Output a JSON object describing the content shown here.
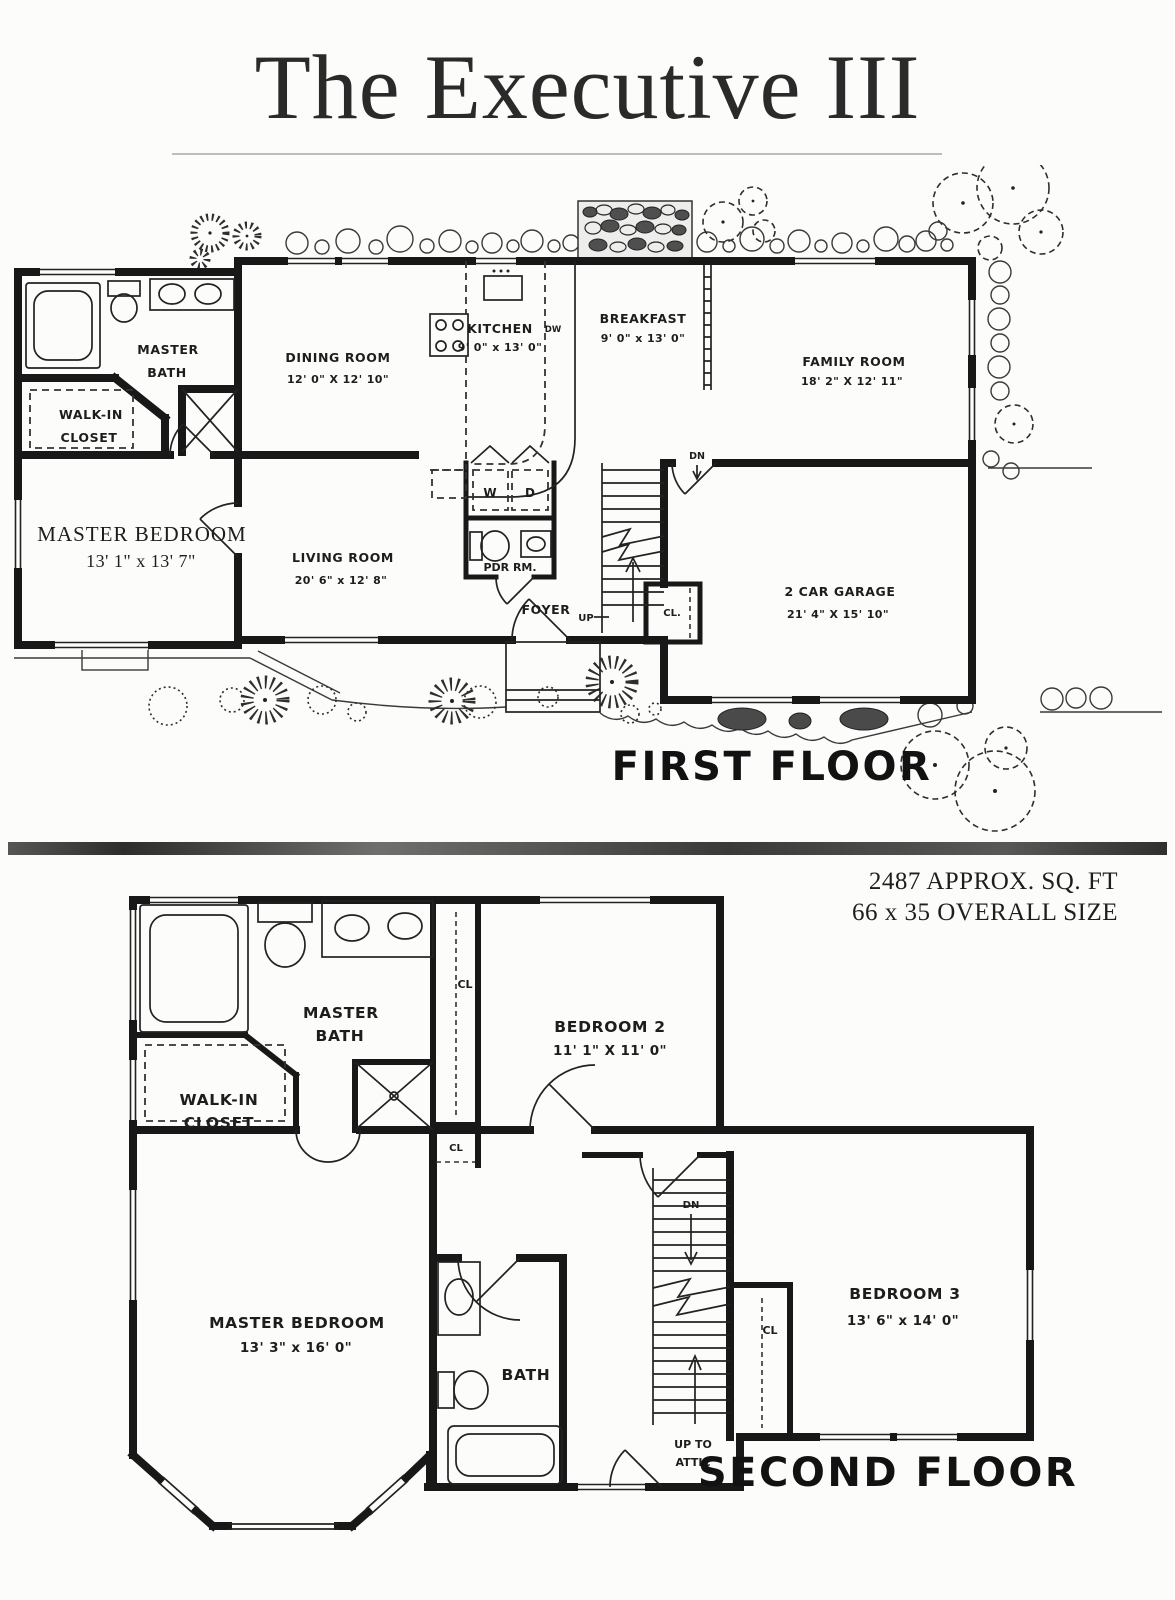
{
  "style": {
    "ink": "#181818",
    "paper": "#fcfcfb",
    "divider_gray": "#3a3a3a"
  },
  "title": "The Executive III",
  "specs": {
    "area": "2487 APPROX. SQ. FT",
    "overall": "66 x 35 OVERALL SIZE"
  },
  "first_floor": {
    "caption": "FIRST FLOOR",
    "master_bath": {
      "line1": "MASTER",
      "line2": "BATH"
    },
    "walk_in_closet": {
      "line1": "WALK-IN",
      "line2": "CLOSET"
    },
    "master_bedroom": {
      "name": "MASTER BEDROOM",
      "dims": "13' 1\" x 13' 7\""
    },
    "dining_room": {
      "name": "DINING ROOM",
      "dims": "12' 0\" X 12' 10\""
    },
    "kitchen": {
      "name": "KITCHEN",
      "dims": "9' 0\" x 13' 0\""
    },
    "breakfast": {
      "name": "BREAKFAST",
      "dims": "9' 0\" x 13' 0\""
    },
    "family_room": {
      "name": "FAMILY ROOM",
      "dims": "18' 2\" X 12' 11\""
    },
    "living_room": {
      "name": "LIVING ROOM",
      "dims": "20' 6\" x 12' 8\""
    },
    "garage": {
      "name": "2 CAR GARAGE",
      "dims": "21' 4\" X 15' 10\""
    },
    "foyer": "FOYER",
    "powder_room": "PDR RM.",
    "washer": "W",
    "dryer": "D",
    "dishwasher": "DW",
    "up": "UP",
    "down": "DN",
    "closet": "CL."
  },
  "second_floor": {
    "caption": "SECOND FLOOR",
    "master_bath": {
      "line1": "MASTER",
      "line2": "BATH"
    },
    "walk_in_closet": {
      "line1": "WALK-IN",
      "line2": "CLOSET"
    },
    "master_bedroom": {
      "name": "MASTER BEDROOM",
      "dims": "13' 3\" x 16' 0\""
    },
    "bedroom_2": {
      "name": "BEDROOM 2",
      "dims": "11' 1\" X 11' 0\""
    },
    "bedroom_3": {
      "name": "BEDROOM 3",
      "dims": "13' 6\" x 14' 0\""
    },
    "bath": "BATH",
    "closet": "CL",
    "down": "DN",
    "attic": {
      "line1": "UP TO",
      "line2": "ATTIC"
    }
  }
}
